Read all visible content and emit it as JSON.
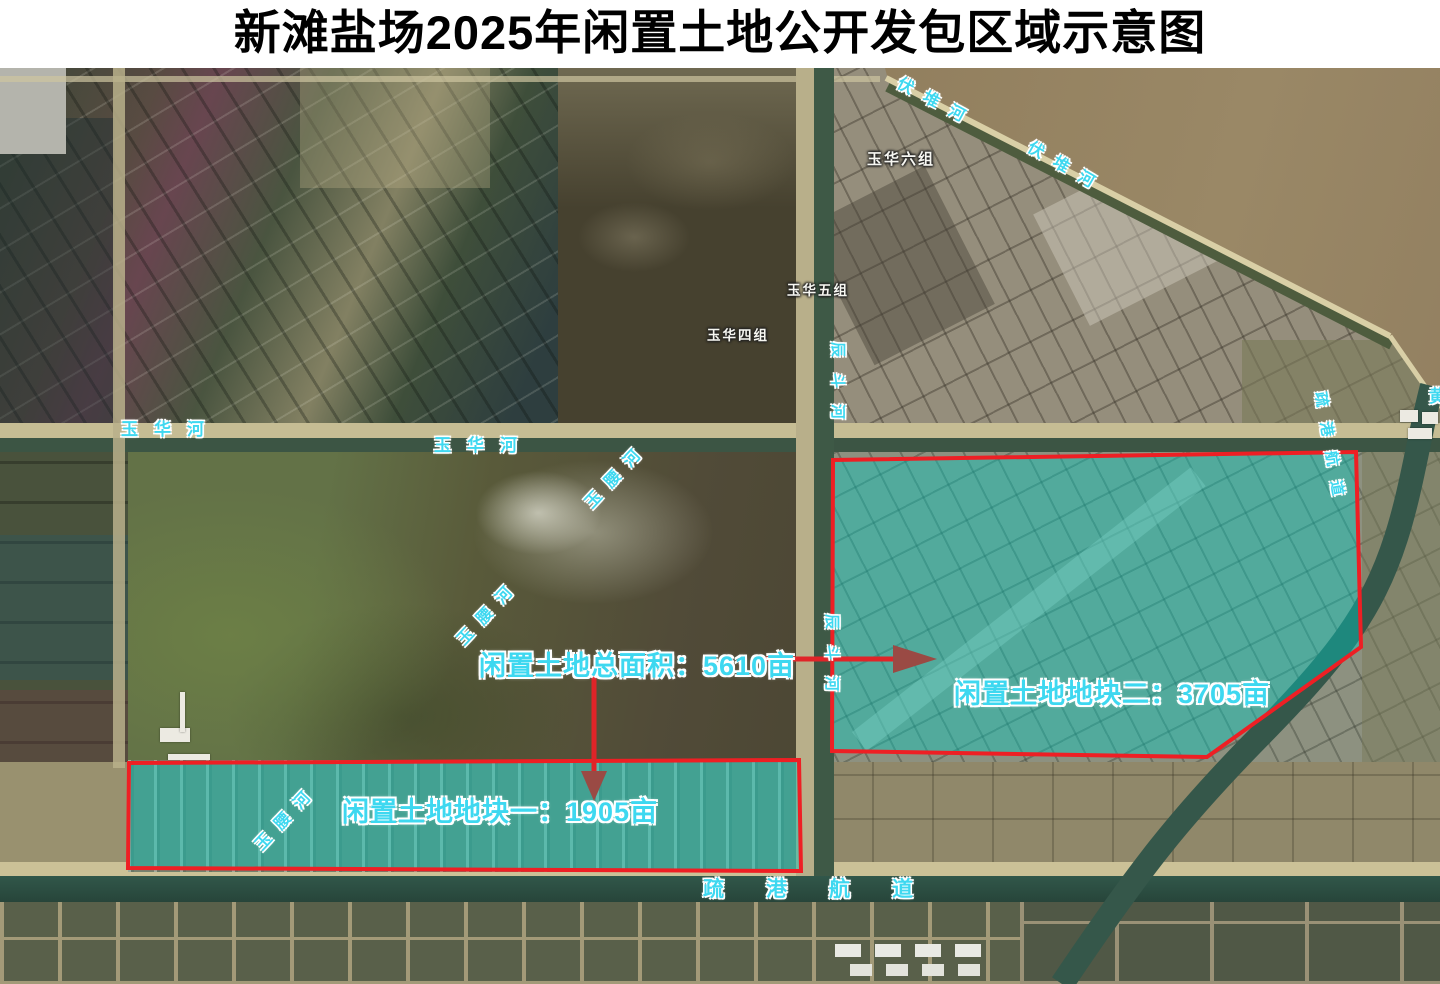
{
  "title": "新滩盐场2025年闲置土地公开发包区域示意图",
  "annotations": {
    "total_label": "闲置土地总面积：5610亩",
    "plot1_label": "闲置土地地块一：1905亩",
    "plot2_label": "闲置土地地块二：3705亩",
    "total_area_mu": 5610,
    "plot1_area_mu": 1905,
    "plot2_area_mu": 3705
  },
  "places": {
    "village_6": "玉华六组",
    "village_5": "玉华五组",
    "village_4": "玉华四组"
  },
  "rivers": {
    "yuhua": "玉华河",
    "fudui": "伏堆河",
    "yuyao": "玉腰河",
    "chendou": "辰斗河",
    "shugang": "疏港航道",
    "sea_partial": "黄"
  },
  "colors": {
    "boundary_red": "#ee1f24",
    "plot_fill_teal": "#00cec4",
    "arrow_line": "#e02428",
    "arrow_head": "#9a4a44",
    "label_cyan": "#3ed8f0",
    "title_black": "#000000"
  }
}
